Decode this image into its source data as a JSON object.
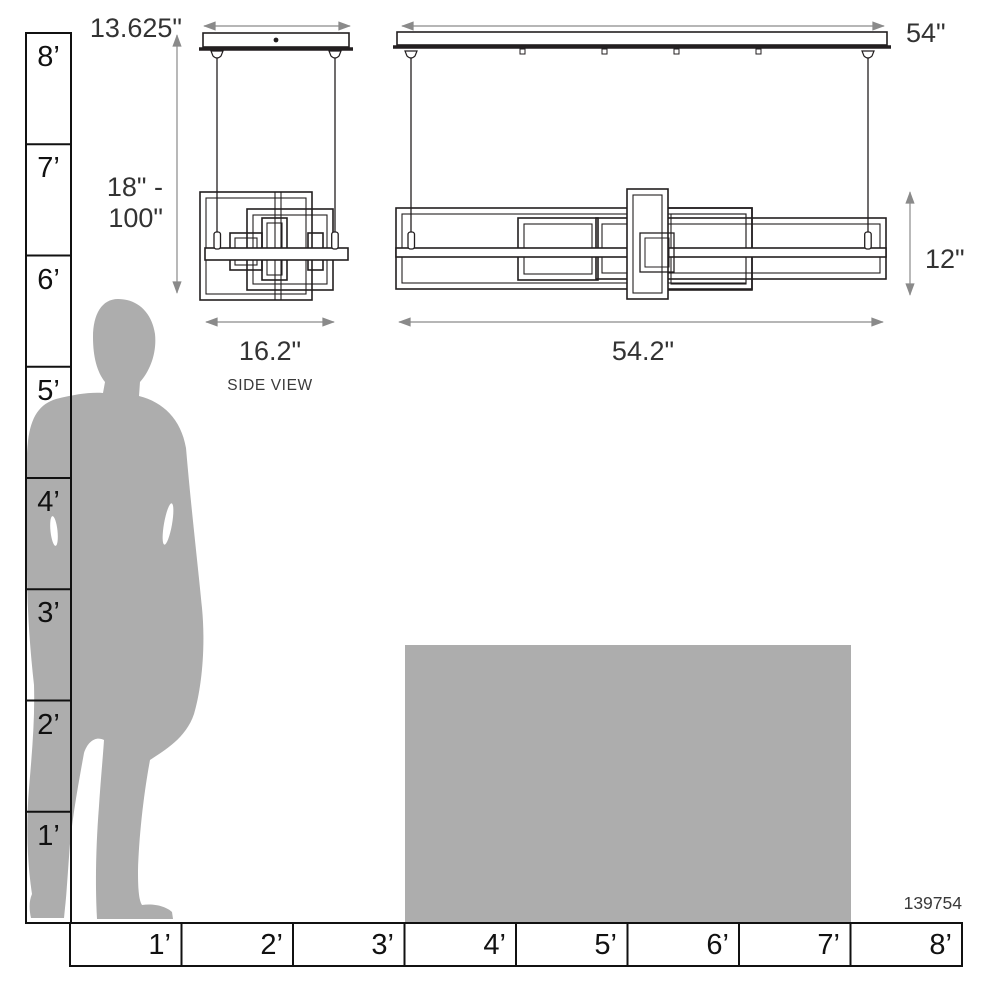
{
  "product": {
    "model_number": "139754"
  },
  "views": {
    "side": {
      "label": "SIDE VIEW",
      "canopy_width": "13.625\"",
      "suspension_range_line1": "18\" -",
      "suspension_range_line2": "100\"",
      "fixture_width": "16.2\""
    },
    "front": {
      "canopy_width": "54\"",
      "fixture_width": "54.2\"",
      "fixture_height": "12\""
    }
  },
  "scale_rulers": {
    "left_ruler_feet": [
      "8’",
      "7’",
      "6’",
      "5’",
      "4’",
      "3’",
      "2’",
      "1’"
    ],
    "bottom_ruler_feet": [
      "1’",
      "2’",
      "3’",
      "4’",
      "5’",
      "6’",
      "7’",
      "8’"
    ]
  },
  "colors": {
    "line": "#231f20",
    "dimension_line": "#8a8a8a",
    "text": "#333333",
    "silhouette_gray": "#adadad",
    "table_gray": "#adadad",
    "background": "#ffffff"
  }
}
